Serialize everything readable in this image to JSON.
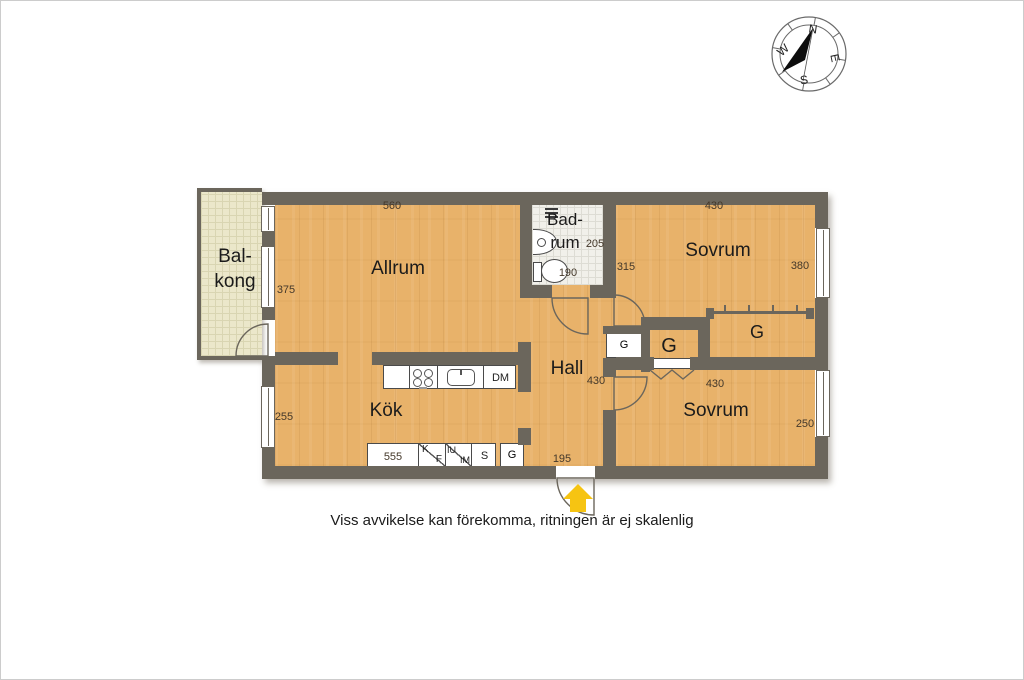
{
  "disclaimer": "Viss avvikelse kan förekomma, ritningen är ej skalenlig",
  "compass": {
    "north": "N",
    "east": "E",
    "south": "S",
    "west": "W"
  },
  "rooms": {
    "balkong": "Bal-\nkong",
    "allrum": "Allrum",
    "kok": "Kök",
    "badrum": "Bad-\nrum",
    "hall": "Hall",
    "sovrum_top": "Sovrum",
    "sovrum_bottom": "Sovrum"
  },
  "dims": {
    "allrum_width": "560",
    "allrum_depth": "375",
    "kok_depth": "255",
    "kok_counter": "555",
    "badrum_depth": "205",
    "badrum_width": "190",
    "sovrum_top_nook": "315",
    "sovrum_top_width": "430",
    "sovrum_top_depth": "380",
    "hall_width": "430",
    "sovrum_bottom_width": "430",
    "sovrum_bottom_depth": "250",
    "entrance_width": "195"
  },
  "kitchen_labels": {
    "dm": "DM",
    "k": "K",
    "f": "F",
    "iu": "IU",
    "im": "IM",
    "s": "S",
    "g": "G"
  },
  "closet_labels": {
    "hall_g": "G",
    "middle_g": "G",
    "sovrum_g": "G"
  },
  "colors": {
    "wall": "#6b665c",
    "floor": "#e8b26a",
    "accent_arrow": "#f6c412"
  }
}
